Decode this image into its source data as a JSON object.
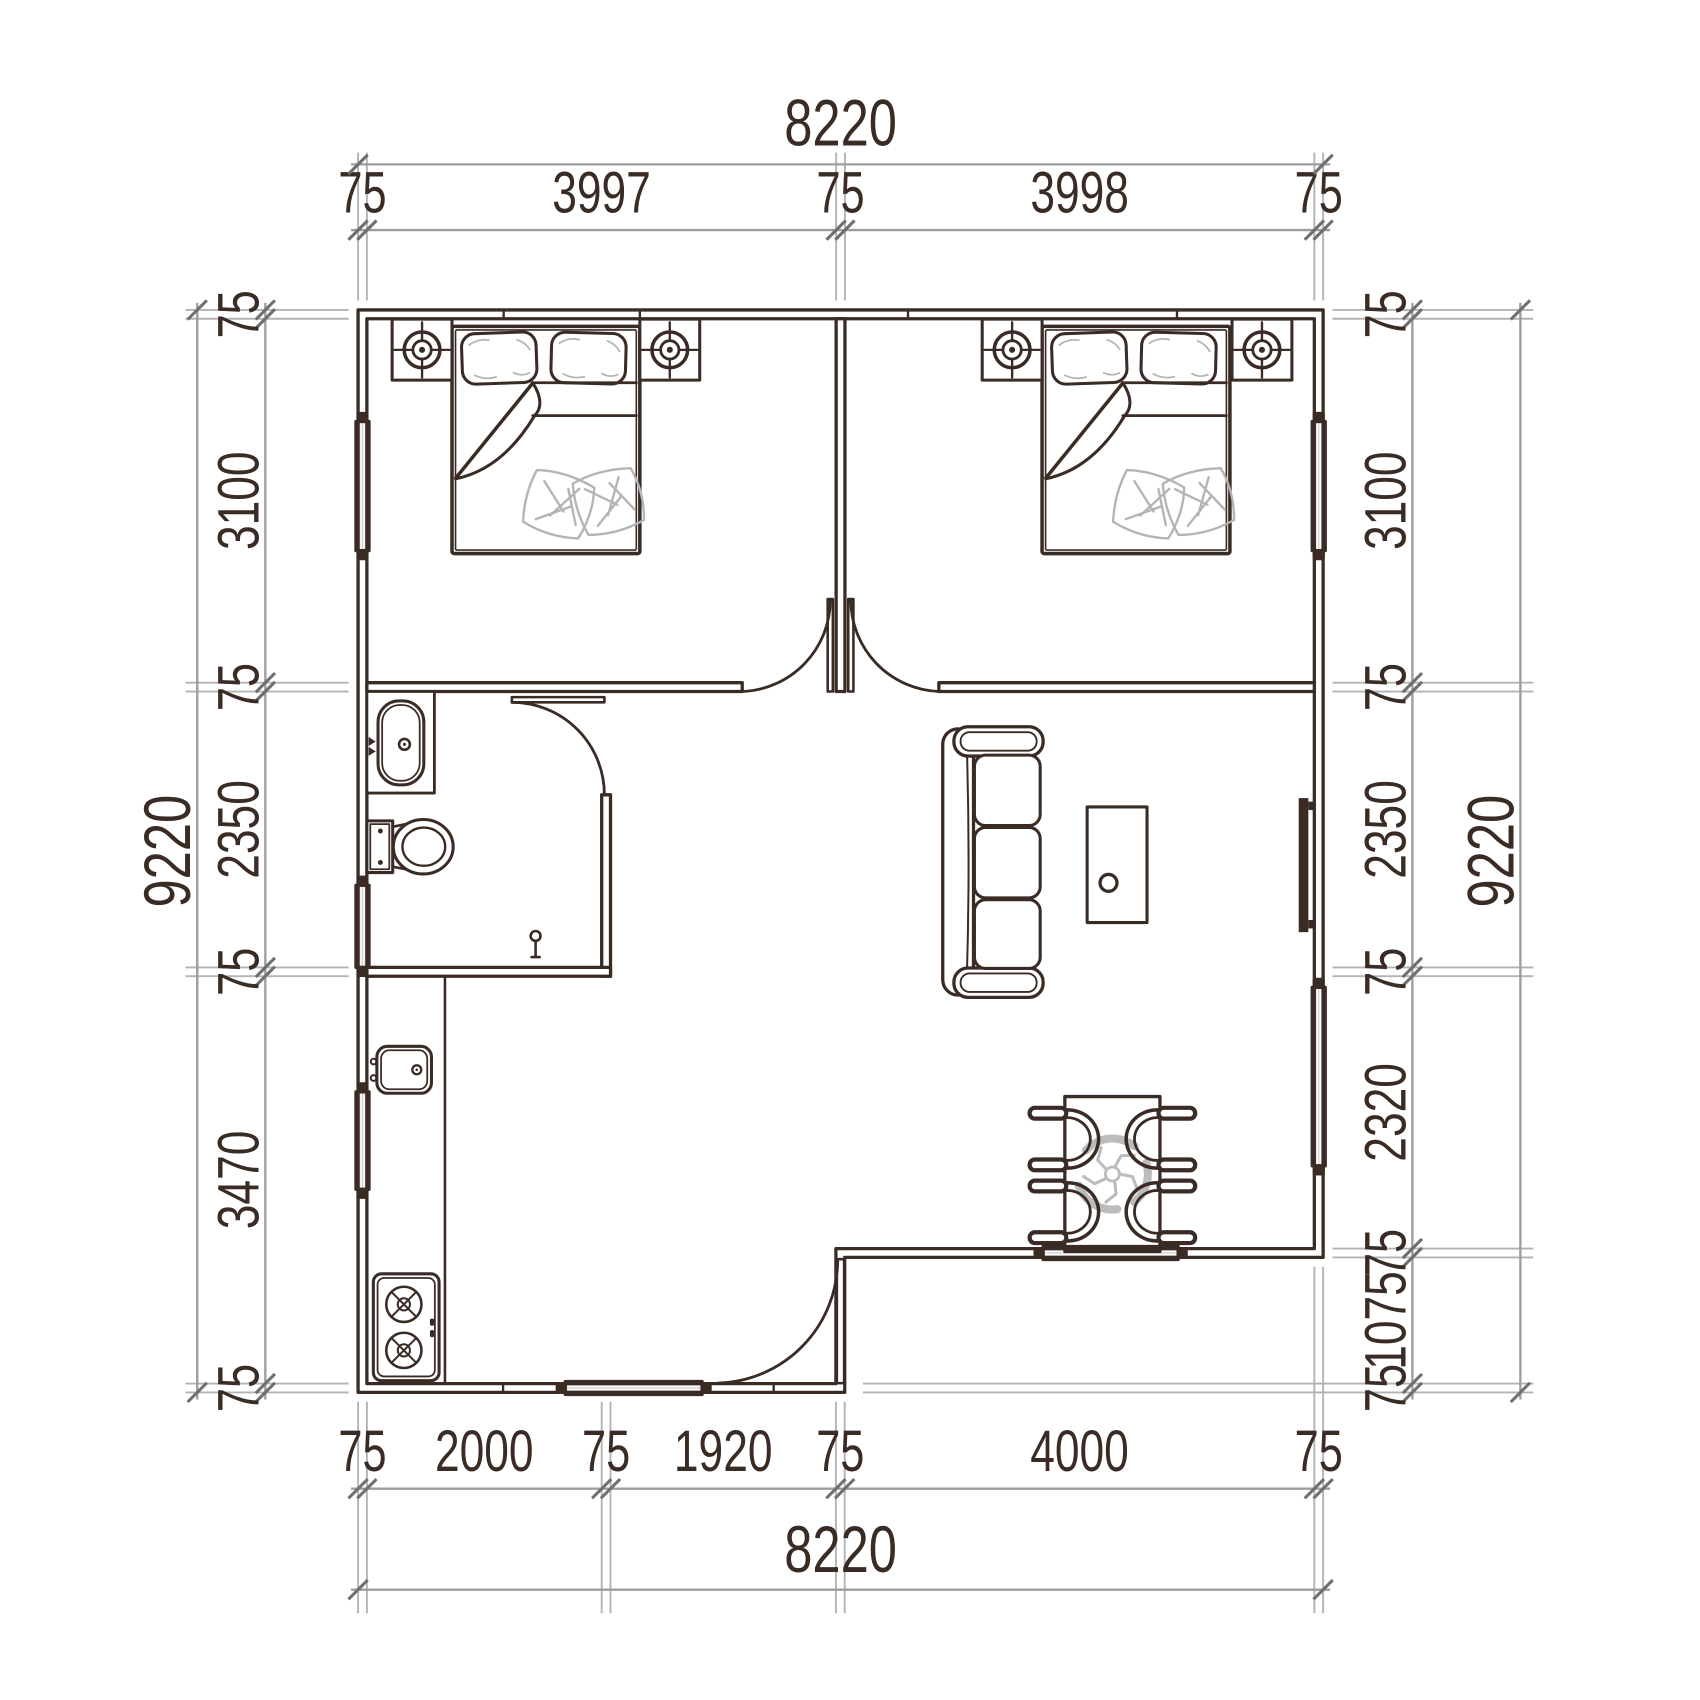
{
  "drawing": {
    "type": "architectural-floor-plan",
    "units": "mm"
  },
  "dimensions": {
    "top": {
      "tier_inner": [
        "75",
        "3997",
        "75",
        "3998",
        "75"
      ],
      "tier_outer": "8220"
    },
    "bottom": {
      "tier_inner": [
        "75",
        "2000",
        "75",
        "1920",
        "75",
        "4000",
        "75"
      ],
      "tier_outer": "8220"
    },
    "left": {
      "tier_inner": [
        "75",
        "3100",
        "75",
        "2350",
        "75",
        "3470",
        "75"
      ],
      "tier_outer": "9220"
    },
    "right": {
      "tier_inner": [
        "75",
        "3100",
        "75",
        "2350",
        "75",
        "2320",
        "75",
        "1075",
        "75"
      ],
      "tier_outer": "9220"
    }
  },
  "fixtures": {
    "bedroom_left": [
      "double-bed-icon",
      "pillow-icon",
      "nightstand-icon",
      "ceiling-light-icon"
    ],
    "bedroom_right": [
      "double-bed-icon",
      "pillow-icon",
      "nightstand-icon",
      "ceiling-light-icon"
    ],
    "bathroom": [
      "washbasin-icon",
      "faucet-icon",
      "toilet-icon",
      "floor-drain-icon",
      "door-swing-icon"
    ],
    "kitchen": [
      "counter-icon",
      "kitchen-sink-icon",
      "gas-stove-icon",
      "window-icon"
    ],
    "living": [
      "sofa-icon",
      "coffee-table-icon",
      "tv-icon"
    ],
    "dining": [
      "dining-table-icon",
      "chair-icon",
      "ceiling-fan-icon"
    ],
    "entry": [
      "entry-door-swing-icon"
    ]
  },
  "colors": {
    "ink": "#3a2b25",
    "dim_line": "#9d9d9d",
    "dim_ext": "#b3b3b3",
    "dim_tick": "#6f6f6f",
    "window_fill": "#d6d6d6",
    "window_line": "#ffffff",
    "accent_gray": "#b4b4b4",
    "fan_gray": "#bcbcbc"
  }
}
